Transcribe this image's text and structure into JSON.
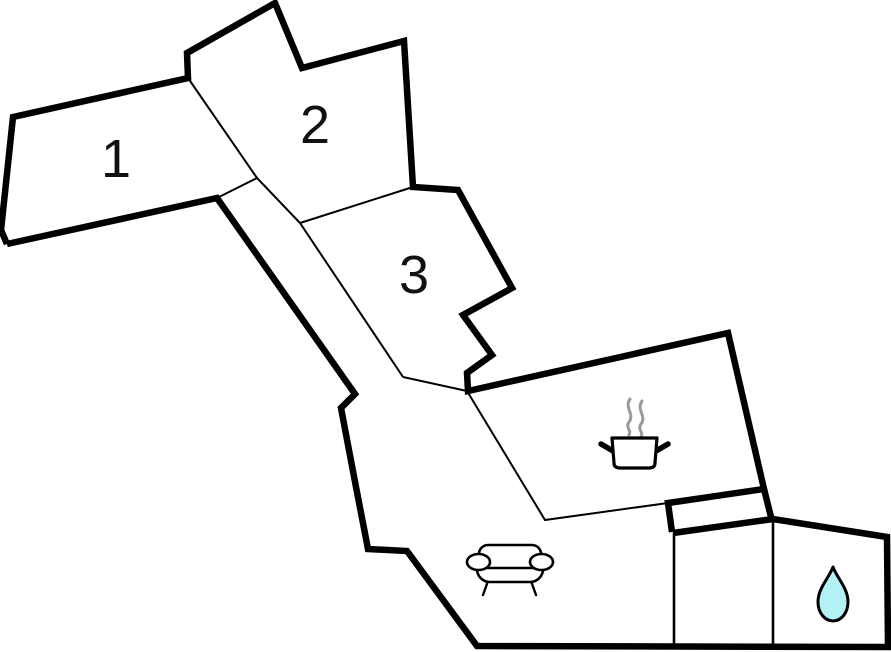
{
  "figure": {
    "type": "floor-plan",
    "description": "Holiday-home floor plan with three numbered rooms, kitchen, living area and bathroom"
  },
  "colors": {
    "wall": "#000000",
    "background": "#ffffff",
    "steam_gray": "#9a9a9a",
    "droplet_fill": "#b4f1f4"
  },
  "rooms": {
    "room1": {
      "label": "1"
    },
    "room2": {
      "label": "2"
    },
    "room3": {
      "label": "3"
    },
    "kitchen": {
      "icon": "cooking-pot-icon"
    },
    "living_room": {
      "icon": "sofa-icon"
    },
    "bathroom": {
      "icon": "water-drop-icon"
    }
  }
}
